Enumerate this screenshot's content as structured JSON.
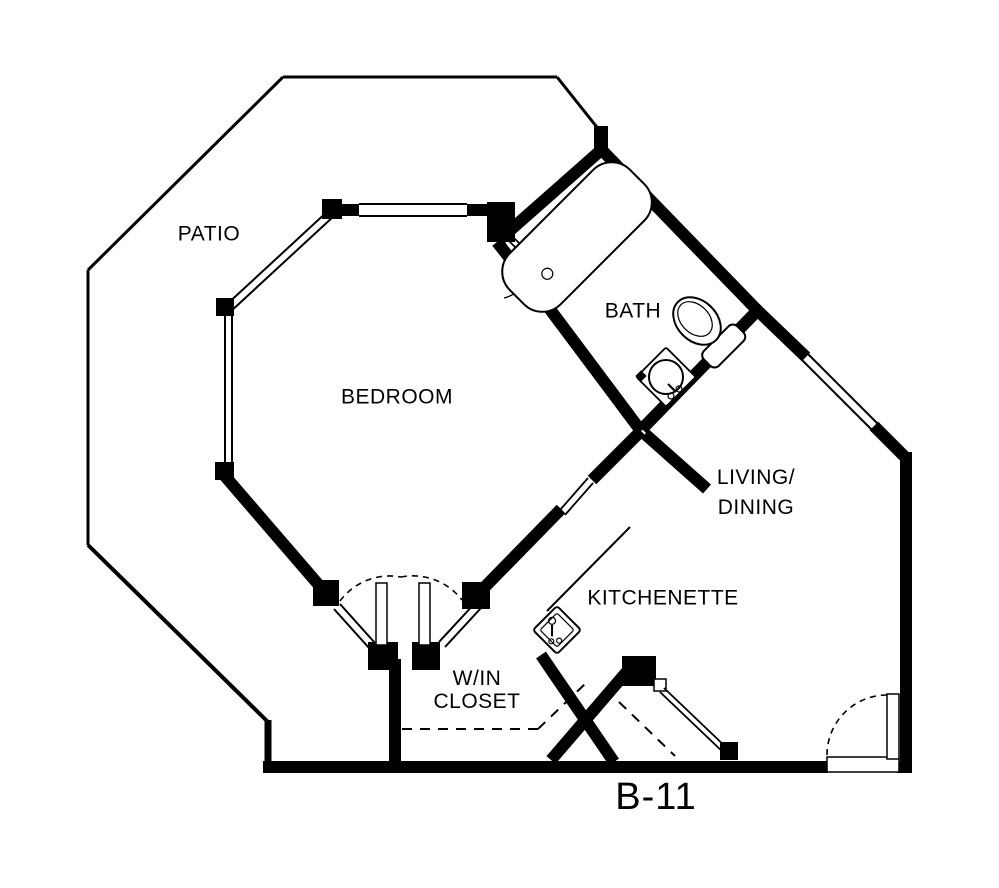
{
  "plan_id": "B-11",
  "rooms": {
    "patio": {
      "label": "PATIO"
    },
    "bedroom": {
      "label": "BEDROOM"
    },
    "bath": {
      "label": "BATH"
    },
    "living_dining": {
      "line1": "LIVING/",
      "line2": "DINING"
    },
    "kitchenette": {
      "label": "KITCHENETTE"
    },
    "closet": {
      "line1": "W/IN",
      "line2": "CLOSET"
    }
  },
  "fixtures": [
    "bathtub",
    "toilet",
    "bathroom-sink",
    "kitchen-sink"
  ],
  "doors": [
    "entry-door",
    "bath-door",
    "closet-double-doors",
    "entry-closet-door",
    "hall-opening"
  ],
  "windows": [
    "bedroom-top-window",
    "bedroom-northwest-window",
    "bedroom-west-window",
    "living-northeast-window"
  ],
  "colors": {
    "ink": "#000000",
    "paper": "#ffffff"
  }
}
